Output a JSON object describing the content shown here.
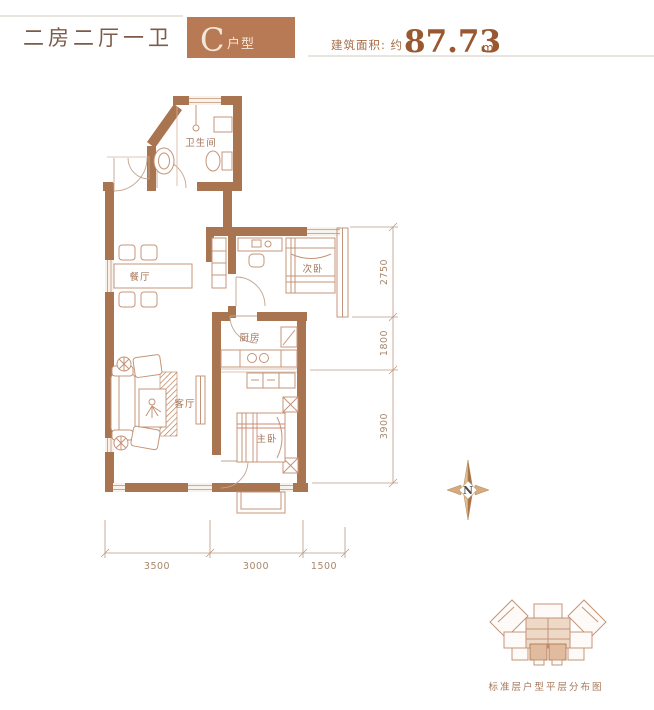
{
  "header": {
    "title": "二房二厅一卫",
    "unit_letter": "C",
    "unit_suffix": "户型",
    "area_prefix": "建筑面积: 约",
    "area_value": "87.73",
    "area_unit": "m²"
  },
  "plan": {
    "rooms": {
      "bathroom": "卫生间",
      "dining": "餐厅",
      "second_bedroom": "次卧",
      "kitchen": "厨房",
      "living": "客厅",
      "master_bedroom": "主卧"
    }
  },
  "dimensions": {
    "right": [
      "2750",
      "1800",
      "3900"
    ],
    "bottom": [
      "3500",
      "3000",
      "1500"
    ]
  },
  "compass": {
    "north": "N"
  },
  "footer": {
    "caption": "标准层户型平层分布图"
  },
  "colors": {
    "wall": "#a97450",
    "accent_box": "#b87a54",
    "furniture_line": "#c49478",
    "dim_line": "#bb9a80",
    "label_text": "#a5775a"
  }
}
